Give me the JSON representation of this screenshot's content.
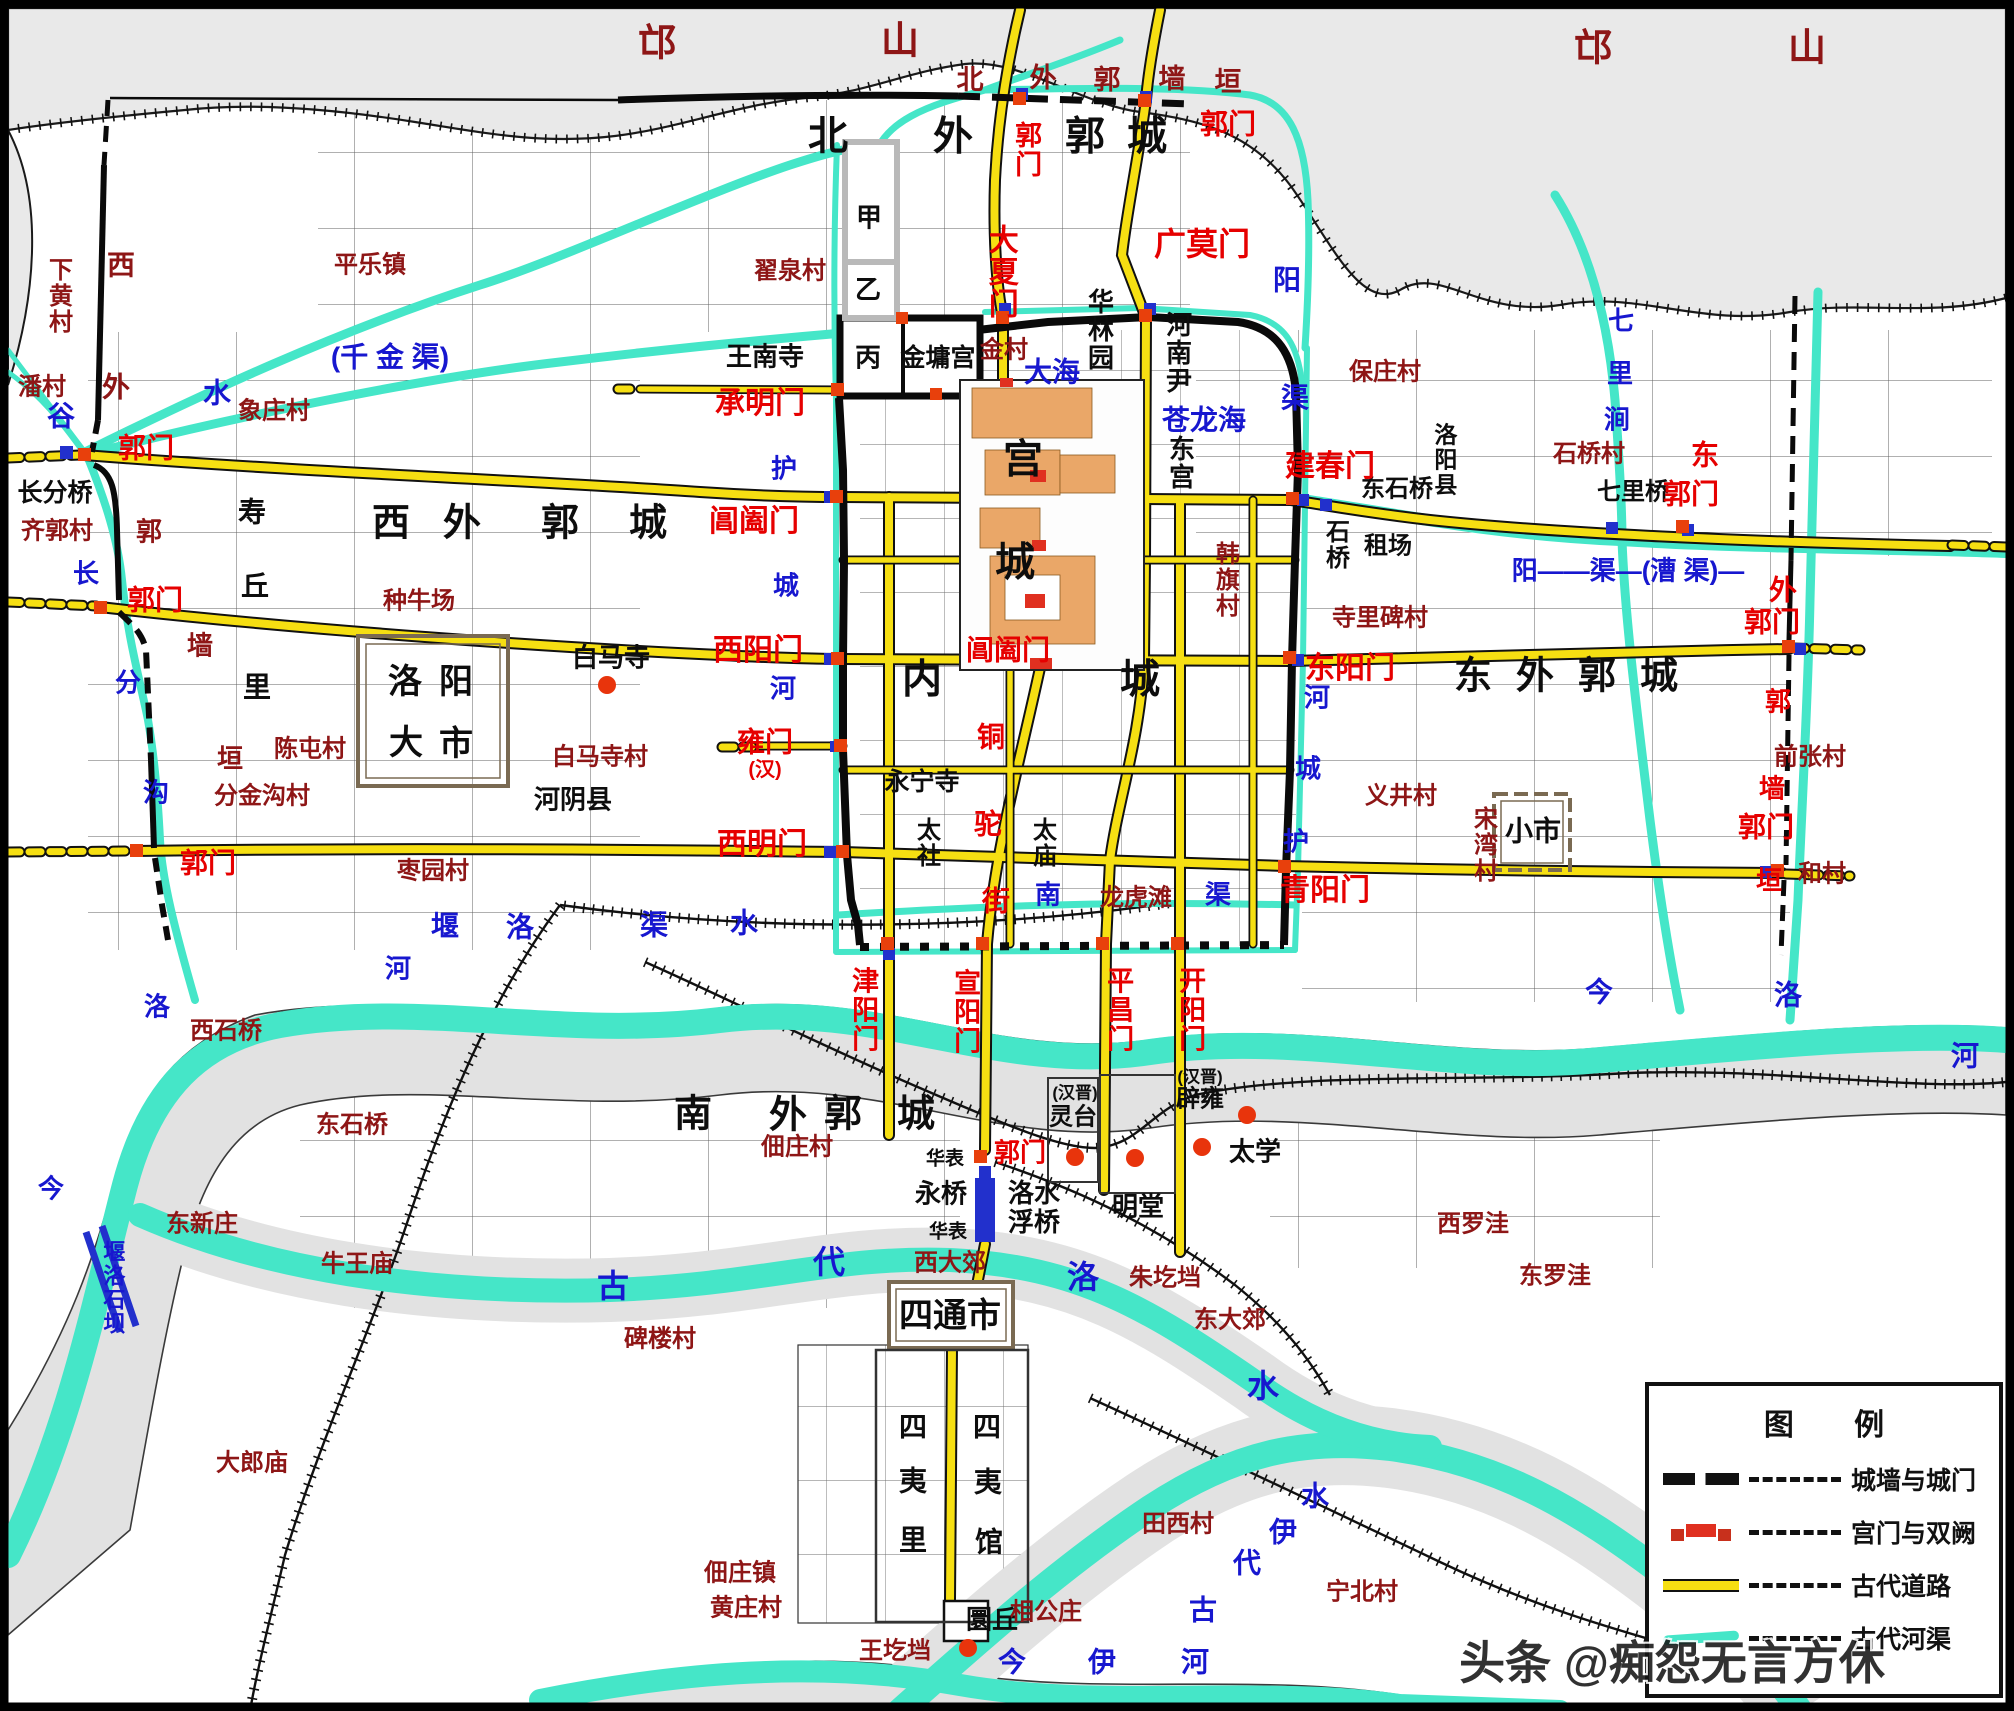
{
  "watermark": "头条 @痴怨无言方休",
  "legend": {
    "title": "图  例",
    "items": [
      {
        "sym": "wall",
        "label": "城墙与城门"
      },
      {
        "sym": "gate",
        "label": "宫门与双阙"
      },
      {
        "sym": "road",
        "label": "古代道路"
      },
      {
        "sym": "canal",
        "label": "古代河渠"
      }
    ]
  },
  "colors": {
    "gate_red": "#e60000",
    "village_red": "#8e1616",
    "water_blue": "#1717cf",
    "road_yellow": "#f6df12",
    "canal_cyan": "#45e6c8",
    "terrain_grey": "#e7e7e7"
  },
  "dots": [
    [
      607,
      685
    ],
    [
      1075,
      1157
    ],
    [
      1135,
      1158
    ],
    [
      1202,
      1147
    ],
    [
      1247,
      1115
    ],
    [
      968,
      1648
    ]
  ],
  "labels": [
    {
      "t": "邙",
      "x": 657,
      "y": 44,
      "c": "v",
      "s": 38
    },
    {
      "t": "山",
      "x": 900,
      "y": 42,
      "c": "v",
      "s": 38
    },
    {
      "t": "邙",
      "x": 1593,
      "y": 49,
      "c": "v",
      "s": 38
    },
    {
      "t": "山",
      "x": 1807,
      "y": 49,
      "c": "v",
      "s": 38
    },
    {
      "t": "北",
      "x": 828,
      "y": 137,
      "c": "b",
      "s": 40
    },
    {
      "t": "外",
      "x": 953,
      "y": 137,
      "c": "b",
      "s": 40
    },
    {
      "t": "郭",
      "x": 1085,
      "y": 137,
      "c": "b",
      "s": 40
    },
    {
      "t": "城",
      "x": 1147,
      "y": 137,
      "c": "b",
      "s": 40
    },
    {
      "t": "郭门",
      "x": 1026,
      "y": 150,
      "c": "g",
      "s": 27,
      "v": 1
    },
    {
      "t": "郭门",
      "x": 1228,
      "y": 124,
      "c": "g",
      "s": 28
    },
    {
      "t": "北",
      "x": 970,
      "y": 80,
      "c": "v",
      "s": 27
    },
    {
      "t": "外",
      "x": 1043,
      "y": 78,
      "c": "v",
      "s": 27
    },
    {
      "t": "郭",
      "x": 1107,
      "y": 80,
      "c": "v",
      "s": 27
    },
    {
      "t": "墙",
      "x": 1172,
      "y": 79,
      "c": "v",
      "s": 27
    },
    {
      "t": "垣",
      "x": 1228,
      "y": 82,
      "c": "v",
      "s": 27
    },
    {
      "t": "大夏门",
      "x": 1000,
      "y": 272,
      "c": "g",
      "s": 30,
      "v": 1
    },
    {
      "t": "广莫门",
      "x": 1202,
      "y": 245,
      "c": "g",
      "s": 32
    },
    {
      "t": "翟泉村",
      "x": 790,
      "y": 272,
      "c": "v",
      "s": 24
    },
    {
      "t": "王南寺",
      "x": 765,
      "y": 357,
      "c": "b",
      "s": 26
    },
    {
      "t": "甲",
      "x": 869,
      "y": 218,
      "c": "b",
      "s": 26
    },
    {
      "t": "乙",
      "x": 868,
      "y": 290,
      "c": "b",
      "s": 26
    },
    {
      "t": "丙",
      "x": 868,
      "y": 358,
      "c": "b",
      "s": 26
    },
    {
      "t": "金墉宫",
      "x": 938,
      "y": 358,
      "c": "b",
      "s": 25
    },
    {
      "t": "金村",
      "x": 1004,
      "y": 351,
      "c": "v",
      "s": 24
    },
    {
      "t": "承明门",
      "x": 760,
      "y": 404,
      "c": "g",
      "s": 30
    },
    {
      "t": "华林园",
      "x": 1099,
      "y": 330,
      "c": "b",
      "s": 26,
      "v": 1
    },
    {
      "t": "河南尹",
      "x": 1177,
      "y": 353,
      "c": "b",
      "s": 26,
      "v": 1
    },
    {
      "t": "大海",
      "x": 1052,
      "y": 372,
      "c": "w",
      "s": 28
    },
    {
      "t": "苍龙海",
      "x": 1204,
      "y": 420,
      "c": "w",
      "s": 28
    },
    {
      "t": "东宫",
      "x": 1180,
      "y": 463,
      "c": "b",
      "s": 26,
      "v": 1
    },
    {
      "t": "阳",
      "x": 1287,
      "y": 280,
      "c": "w",
      "s": 28
    },
    {
      "t": "渠",
      "x": 1295,
      "y": 398,
      "c": "w",
      "s": 28
    },
    {
      "t": "保庄村",
      "x": 1385,
      "y": 373,
      "c": "v",
      "s": 24
    },
    {
      "t": "洛阳县",
      "x": 1443,
      "y": 460,
      "c": "b",
      "s": 23,
      "v": 1
    },
    {
      "t": "东石桥",
      "x": 1397,
      "y": 490,
      "c": "b",
      "s": 24
    },
    {
      "t": "石桥",
      "x": 1334,
      "y": 545,
      "c": "b",
      "s": 24,
      "v": 1
    },
    {
      "t": "租场",
      "x": 1388,
      "y": 547,
      "c": "b",
      "s": 24
    },
    {
      "t": "建春门",
      "x": 1330,
      "y": 467,
      "c": "g",
      "s": 30
    },
    {
      "t": "七",
      "x": 1621,
      "y": 321,
      "c": "w",
      "s": 26
    },
    {
      "t": "里",
      "x": 1620,
      "y": 374,
      "c": "w",
      "s": 26
    },
    {
      "t": "涧",
      "x": 1617,
      "y": 420,
      "c": "w",
      "s": 26
    },
    {
      "t": "石桥村",
      "x": 1589,
      "y": 455,
      "c": "v",
      "s": 24
    },
    {
      "t": "七里桥",
      "x": 1633,
      "y": 493,
      "c": "b",
      "s": 24
    },
    {
      "t": "东",
      "x": 1705,
      "y": 455,
      "c": "g",
      "s": 28
    },
    {
      "t": "郭门",
      "x": 1691,
      "y": 494,
      "c": "g",
      "s": 28
    },
    {
      "t": "下黄村",
      "x": 57,
      "y": 296,
      "c": "v",
      "s": 24,
      "v": 1
    },
    {
      "t": "西",
      "x": 121,
      "y": 266,
      "c": "v",
      "s": 28
    },
    {
      "t": "潘村",
      "x": 42,
      "y": 388,
      "c": "v",
      "s": 24
    },
    {
      "t": "外",
      "x": 116,
      "y": 388,
      "c": "v",
      "s": 28
    },
    {
      "t": "谷",
      "x": 61,
      "y": 416,
      "c": "w",
      "s": 28
    },
    {
      "t": "水",
      "x": 217,
      "y": 393,
      "c": "w",
      "s": 28
    },
    {
      "t": "(千  金  渠)",
      "x": 390,
      "y": 357,
      "c": "w",
      "s": 28
    },
    {
      "t": "平乐镇",
      "x": 370,
      "y": 266,
      "c": "v",
      "s": 24
    },
    {
      "t": "象庄村",
      "x": 274,
      "y": 412,
      "c": "v",
      "s": 24
    },
    {
      "t": "郭门",
      "x": 146,
      "y": 448,
      "c": "g",
      "s": 28
    },
    {
      "t": "长分桥",
      "x": 55,
      "y": 493,
      "c": "b",
      "s": 25
    },
    {
      "t": "齐郭村",
      "x": 57,
      "y": 532,
      "c": "v",
      "s": 24
    },
    {
      "t": "郭",
      "x": 149,
      "y": 532,
      "c": "v",
      "s": 26
    },
    {
      "t": "长",
      "x": 86,
      "y": 574,
      "c": "w",
      "s": 26
    },
    {
      "t": "郭门",
      "x": 155,
      "y": 600,
      "c": "g",
      "s": 28
    },
    {
      "t": "墙",
      "x": 200,
      "y": 646,
      "c": "v",
      "s": 26
    },
    {
      "t": "分",
      "x": 128,
      "y": 683,
      "c": "w",
      "s": 26
    },
    {
      "t": "垣",
      "x": 230,
      "y": 759,
      "c": "v",
      "s": 26
    },
    {
      "t": "沟",
      "x": 156,
      "y": 793,
      "c": "w",
      "s": 26
    },
    {
      "t": "郭门",
      "x": 208,
      "y": 863,
      "c": "g",
      "s": 28
    },
    {
      "t": "寿",
      "x": 252,
      "y": 512,
      "c": "b",
      "s": 28
    },
    {
      "t": "丘",
      "x": 255,
      "y": 586,
      "c": "b",
      "s": 28
    },
    {
      "t": "里",
      "x": 257,
      "y": 687,
      "c": "b",
      "s": 28
    },
    {
      "t": "西",
      "x": 391,
      "y": 524,
      "c": "b",
      "s": 38
    },
    {
      "t": "外",
      "x": 462,
      "y": 524,
      "c": "b",
      "s": 38
    },
    {
      "t": "郭",
      "x": 560,
      "y": 524,
      "c": "b",
      "s": 38
    },
    {
      "t": "城",
      "x": 648,
      "y": 524,
      "c": "b",
      "s": 38
    },
    {
      "t": "种牛场",
      "x": 419,
      "y": 602,
      "c": "v",
      "s": 24
    },
    {
      "t": "洛",
      "x": 405,
      "y": 682,
      "c": "b",
      "s": 34
    },
    {
      "t": "阳",
      "x": 456,
      "y": 682,
      "c": "b",
      "s": 34
    },
    {
      "t": "大",
      "x": 406,
      "y": 743,
      "c": "b",
      "s": 34
    },
    {
      "t": "市",
      "x": 456,
      "y": 744,
      "c": "b",
      "s": 34
    },
    {
      "t": "白马寺",
      "x": 611,
      "y": 658,
      "c": "b",
      "s": 26
    },
    {
      "t": "陈屯村",
      "x": 310,
      "y": 750,
      "c": "v",
      "s": 24
    },
    {
      "t": "白马寺村",
      "x": 600,
      "y": 758,
      "c": "v",
      "s": 24
    },
    {
      "t": "分金沟村",
      "x": 262,
      "y": 797,
      "c": "v",
      "s": 24
    },
    {
      "t": "河阴县",
      "x": 573,
      "y": 800,
      "c": "b",
      "s": 26
    },
    {
      "t": "枣园村",
      "x": 433,
      "y": 872,
      "c": "v",
      "s": 24
    },
    {
      "t": "阊阖门",
      "x": 754,
      "y": 522,
      "c": "g",
      "s": 30
    },
    {
      "t": "西阳门",
      "x": 758,
      "y": 651,
      "c": "g",
      "s": 30
    },
    {
      "t": "雍门",
      "x": 765,
      "y": 742,
      "c": "g",
      "s": 28
    },
    {
      "t": "(汉)",
      "x": 765,
      "y": 770,
      "c": "g",
      "s": 20
    },
    {
      "t": "西明门",
      "x": 762,
      "y": 845,
      "c": "g",
      "s": 30
    },
    {
      "t": "护",
      "x": 784,
      "y": 469,
      "c": "w",
      "s": 26
    },
    {
      "t": "城",
      "x": 786,
      "y": 586,
      "c": "w",
      "s": 26
    },
    {
      "t": "河",
      "x": 783,
      "y": 689,
      "c": "w",
      "s": 26
    },
    {
      "t": "阊阖门",
      "x": 1008,
      "y": 650,
      "c": "g",
      "s": 28
    },
    {
      "t": "内",
      "x": 922,
      "y": 680,
      "c": "b",
      "s": 40
    },
    {
      "t": "城",
      "x": 1140,
      "y": 680,
      "c": "b",
      "s": 40
    },
    {
      "t": "宫",
      "x": 1023,
      "y": 460,
      "c": "b",
      "s": 40
    },
    {
      "t": "城",
      "x": 1015,
      "y": 563,
      "c": "b",
      "s": 40
    },
    {
      "t": "铜",
      "x": 991,
      "y": 737,
      "c": "g",
      "s": 28
    },
    {
      "t": "驼",
      "x": 988,
      "y": 824,
      "c": "g",
      "s": 28
    },
    {
      "t": "街",
      "x": 996,
      "y": 901,
      "c": "g",
      "s": 28
    },
    {
      "t": "永宁寺",
      "x": 922,
      "y": 782,
      "c": "b",
      "s": 25
    },
    {
      "t": "太社",
      "x": 925,
      "y": 843,
      "c": "b",
      "s": 24,
      "v": 1
    },
    {
      "t": "太庙",
      "x": 1041,
      "y": 843,
      "c": "b",
      "s": 24,
      "v": 1
    },
    {
      "t": "东阳门",
      "x": 1350,
      "y": 669,
      "c": "g",
      "s": 30
    },
    {
      "t": "河",
      "x": 1317,
      "y": 698,
      "c": "w",
      "s": 26
    },
    {
      "t": "城",
      "x": 1308,
      "y": 769,
      "c": "w",
      "s": 26
    },
    {
      "t": "护",
      "x": 1296,
      "y": 842,
      "c": "w",
      "s": 26
    },
    {
      "t": "青阳门",
      "x": 1325,
      "y": 891,
      "c": "g",
      "s": 30
    },
    {
      "t": "韩旗村",
      "x": 1224,
      "y": 580,
      "c": "v",
      "s": 24,
      "v": 1
    },
    {
      "t": "寺里碑村",
      "x": 1380,
      "y": 619,
      "c": "v",
      "s": 24
    },
    {
      "t": "义井村",
      "x": 1401,
      "y": 797,
      "c": "v",
      "s": 24
    },
    {
      "t": "宋湾村",
      "x": 1482,
      "y": 845,
      "c": "v",
      "s": 24,
      "v": 1
    },
    {
      "t": "阳——渠—(漕 渠)—",
      "x": 1628,
      "y": 571,
      "c": "w",
      "s": 26
    },
    {
      "t": "外",
      "x": 1783,
      "y": 590,
      "c": "g",
      "s": 28
    },
    {
      "t": "郭门",
      "x": 1772,
      "y": 622,
      "c": "g",
      "s": 28
    },
    {
      "t": "郭",
      "x": 1778,
      "y": 702,
      "c": "g",
      "s": 26
    },
    {
      "t": "墙",
      "x": 1772,
      "y": 789,
      "c": "g",
      "s": 26
    },
    {
      "t": "郭门",
      "x": 1766,
      "y": 827,
      "c": "g",
      "s": 28
    },
    {
      "t": "垣",
      "x": 1769,
      "y": 881,
      "c": "g",
      "s": 26
    },
    {
      "t": "和村",
      "x": 1822,
      "y": 875,
      "c": "v",
      "s": 24
    },
    {
      "t": "前张村",
      "x": 1810,
      "y": 758,
      "c": "v",
      "s": 24
    },
    {
      "t": "东",
      "x": 1473,
      "y": 677,
      "c": "b",
      "s": 38
    },
    {
      "t": "外",
      "x": 1535,
      "y": 677,
      "c": "b",
      "s": 38
    },
    {
      "t": "郭",
      "x": 1597,
      "y": 677,
      "c": "b",
      "s": 38
    },
    {
      "t": "城",
      "x": 1659,
      "y": 677,
      "c": "b",
      "s": 38
    },
    {
      "t": "小市",
      "x": 1533,
      "y": 831,
      "c": "b",
      "s": 28
    },
    {
      "t": "南",
      "x": 1048,
      "y": 895,
      "c": "w",
      "s": 26
    },
    {
      "t": "龙虎滩",
      "x": 1136,
      "y": 899,
      "c": "v",
      "s": 24
    },
    {
      "t": "渠",
      "x": 1218,
      "y": 895,
      "c": "w",
      "s": 26
    },
    {
      "t": "堰",
      "x": 445,
      "y": 926,
      "c": "w",
      "s": 28
    },
    {
      "t": "洛",
      "x": 520,
      "y": 927,
      "c": "w",
      "s": 28
    },
    {
      "t": "渠",
      "x": 654,
      "y": 925,
      "c": "w",
      "s": 28
    },
    {
      "t": "水",
      "x": 744,
      "y": 923,
      "c": "w",
      "s": 28
    },
    {
      "t": "河",
      "x": 398,
      "y": 969,
      "c": "w",
      "s": 26
    },
    {
      "t": "津阳门",
      "x": 863,
      "y": 1010,
      "c": "g",
      "s": 27,
      "v": 1
    },
    {
      "t": "宣阳门",
      "x": 965,
      "y": 1012,
      "c": "g",
      "s": 27,
      "v": 1
    },
    {
      "t": "平昌门",
      "x": 1118,
      "y": 1010,
      "c": "g",
      "s": 27,
      "v": 1
    },
    {
      "t": "开阳门",
      "x": 1190,
      "y": 1010,
      "c": "g",
      "s": 27,
      "v": 1
    },
    {
      "t": "(汉晋)",
      "x": 1075,
      "y": 1093,
      "c": "b",
      "s": 17
    },
    {
      "t": "灵台",
      "x": 1073,
      "y": 1118,
      "c": "b",
      "s": 24
    },
    {
      "t": "(汉晋)",
      "x": 1200,
      "y": 1077,
      "c": "b",
      "s": 17
    },
    {
      "t": "辟雍",
      "x": 1200,
      "y": 1100,
      "c": "b",
      "s": 24
    },
    {
      "t": "太学",
      "x": 1255,
      "y": 1152,
      "c": "b",
      "s": 26
    },
    {
      "t": "明堂",
      "x": 1138,
      "y": 1207,
      "c": "b",
      "s": 26
    },
    {
      "t": "南",
      "x": 693,
      "y": 1115,
      "c": "b",
      "s": 38
    },
    {
      "t": "外",
      "x": 788,
      "y": 1116,
      "c": "b",
      "s": 38
    },
    {
      "t": "郭",
      "x": 843,
      "y": 1115,
      "c": "b",
      "s": 38
    },
    {
      "t": "城",
      "x": 916,
      "y": 1115,
      "c": "b",
      "s": 38
    },
    {
      "t": "佃庄村",
      "x": 797,
      "y": 1148,
      "c": "v",
      "s": 24
    },
    {
      "t": "华表",
      "x": 945,
      "y": 1159,
      "c": "b",
      "s": 19
    },
    {
      "t": "郭门",
      "x": 1020,
      "y": 1153,
      "c": "g",
      "s": 26
    },
    {
      "t": "永桥",
      "x": 941,
      "y": 1194,
      "c": "b",
      "s": 26
    },
    {
      "t": "洛水\n浮桥",
      "x": 1034,
      "y": 1208,
      "c": "b",
      "s": 26
    },
    {
      "t": "华表",
      "x": 948,
      "y": 1232,
      "c": "b",
      "s": 19
    },
    {
      "t": "西大郊",
      "x": 950,
      "y": 1264,
      "c": "v",
      "s": 24
    },
    {
      "t": "朱圪垱",
      "x": 1165,
      "y": 1279,
      "c": "v",
      "s": 24
    },
    {
      "t": "东大郊",
      "x": 1230,
      "y": 1321,
      "c": "v",
      "s": 24
    },
    {
      "t": "今",
      "x": 1599,
      "y": 992,
      "c": "w",
      "s": 28
    },
    {
      "t": "洛",
      "x": 1788,
      "y": 995,
      "c": "w",
      "s": 28
    },
    {
      "t": "河",
      "x": 1965,
      "y": 1056,
      "c": "w",
      "s": 28
    },
    {
      "t": "西罗洼",
      "x": 1473,
      "y": 1225,
      "c": "v",
      "s": 24
    },
    {
      "t": "东罗洼",
      "x": 1555,
      "y": 1277,
      "c": "v",
      "s": 24
    },
    {
      "t": "西石桥",
      "x": 226,
      "y": 1032,
      "c": "v",
      "s": 24
    },
    {
      "t": "东石桥",
      "x": 352,
      "y": 1126,
      "c": "v",
      "s": 24
    },
    {
      "t": "东新庄",
      "x": 202,
      "y": 1225,
      "c": "v",
      "s": 24
    },
    {
      "t": "牛王庙",
      "x": 357,
      "y": 1265,
      "c": "v",
      "s": 24
    },
    {
      "t": "堰洛石坝",
      "x": 112,
      "y": 1288,
      "c": "w",
      "s": 22,
      "v": 1
    },
    {
      "t": "今",
      "x": 51,
      "y": 1189,
      "c": "w",
      "s": 26
    },
    {
      "t": "洛",
      "x": 157,
      "y": 1007,
      "c": "w",
      "s": 26
    },
    {
      "t": "大郎庙",
      "x": 252,
      "y": 1464,
      "c": "v",
      "s": 24
    },
    {
      "t": "古",
      "x": 613,
      "y": 1287,
      "c": "w",
      "s": 32
    },
    {
      "t": "代",
      "x": 829,
      "y": 1263,
      "c": "w",
      "s": 32
    },
    {
      "t": "洛",
      "x": 1083,
      "y": 1278,
      "c": "w",
      "s": 32
    },
    {
      "t": "水",
      "x": 1263,
      "y": 1387,
      "c": "w",
      "s": 32
    },
    {
      "t": "古",
      "x": 1203,
      "y": 1610,
      "c": "w",
      "s": 28
    },
    {
      "t": "代",
      "x": 1247,
      "y": 1563,
      "c": "w",
      "s": 28
    },
    {
      "t": "伊",
      "x": 1283,
      "y": 1532,
      "c": "w",
      "s": 28
    },
    {
      "t": "水",
      "x": 1315,
      "y": 1496,
      "c": "w",
      "s": 28
    },
    {
      "t": "今",
      "x": 1012,
      "y": 1662,
      "c": "w",
      "s": 28
    },
    {
      "t": "伊",
      "x": 1102,
      "y": 1662,
      "c": "w",
      "s": 28
    },
    {
      "t": "河",
      "x": 1195,
      "y": 1662,
      "c": "w",
      "s": 28
    },
    {
      "t": "碑楼村",
      "x": 660,
      "y": 1340,
      "c": "v",
      "s": 24
    },
    {
      "t": "佃庄镇",
      "x": 740,
      "y": 1574,
      "c": "v",
      "s": 24
    },
    {
      "t": "黄庄村",
      "x": 746,
      "y": 1609,
      "c": "v",
      "s": 24
    },
    {
      "t": "四通市",
      "x": 950,
      "y": 1316,
      "c": "b",
      "s": 34
    },
    {
      "t": "四",
      "x": 913,
      "y": 1427,
      "c": "b",
      "s": 28
    },
    {
      "t": "夷",
      "x": 913,
      "y": 1481,
      "c": "b",
      "s": 28
    },
    {
      "t": "里",
      "x": 913,
      "y": 1540,
      "c": "b",
      "s": 28
    },
    {
      "t": "四",
      "x": 987,
      "y": 1427,
      "c": "b",
      "s": 28
    },
    {
      "t": "夷",
      "x": 988,
      "y": 1482,
      "c": "b",
      "s": 28
    },
    {
      "t": "馆",
      "x": 989,
      "y": 1542,
      "c": "b",
      "s": 28
    },
    {
      "t": "圜丘",
      "x": 992,
      "y": 1620,
      "c": "b",
      "s": 26
    },
    {
      "t": "王圪垱",
      "x": 895,
      "y": 1652,
      "c": "v",
      "s": 24
    },
    {
      "t": "相公庄",
      "x": 1046,
      "y": 1613,
      "c": "v",
      "s": 24
    },
    {
      "t": "田西村",
      "x": 1178,
      "y": 1525,
      "c": "v",
      "s": 24
    },
    {
      "t": "宁北村",
      "x": 1362,
      "y": 1593,
      "c": "v",
      "s": 24
    }
  ]
}
